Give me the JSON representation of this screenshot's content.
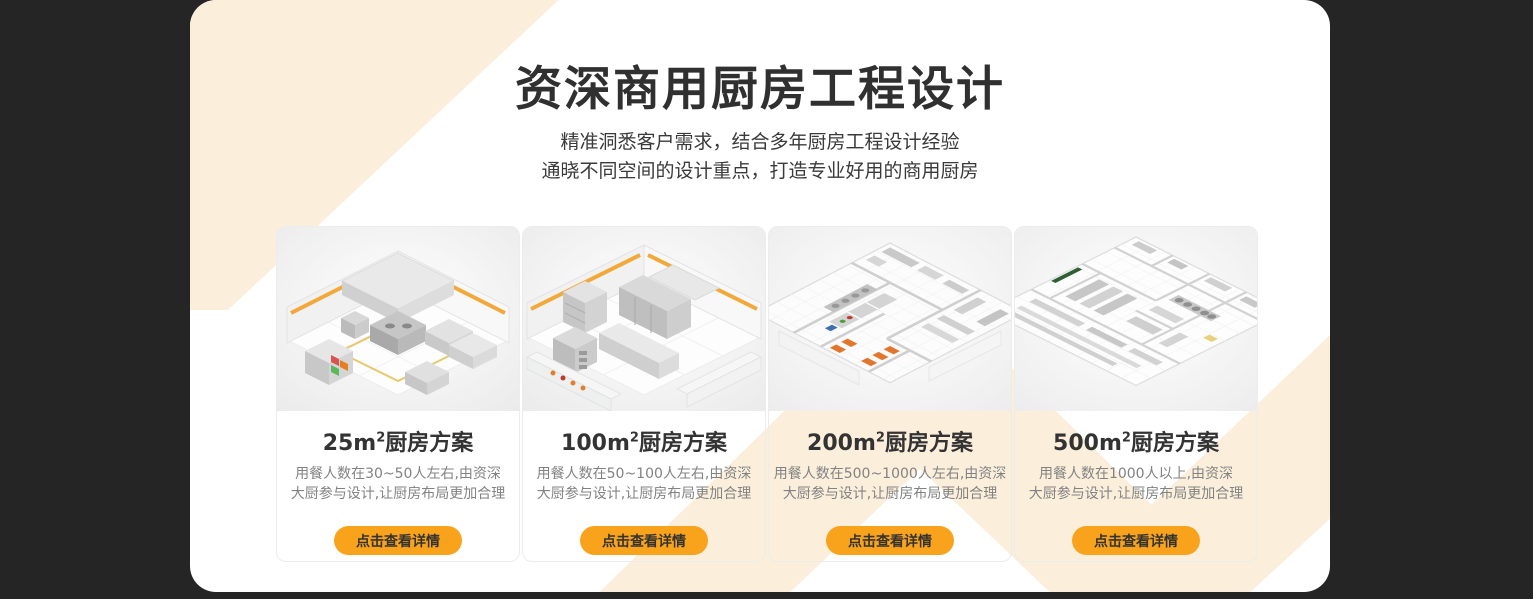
{
  "header": {
    "title": "资深商用厨房工程设计",
    "subtitle_line1": "精准洞悉客户需求，结合多年厨房工程设计经验",
    "subtitle_line2": "通晓不同空间的设计重点，打造专业好用的商用厨房"
  },
  "colors": {
    "accent_orange": "#F9A21C",
    "cream_decoration": "#FBEFDC",
    "panel_background": "#FFFFFF",
    "page_background": "#252525",
    "title_text": "#303030",
    "description_text": "#828282",
    "wall_stripe_yellow": "#F2A93B"
  },
  "cards": [
    {
      "title_prefix": "25m",
      "title_sup": "2",
      "title_suffix": "厨房方案",
      "desc_line1": "用餐人数在30~50人左右,由资深",
      "desc_line2": "大厨参与设计,让厨房布局更加合理",
      "button_label": "点击查看详情"
    },
    {
      "title_prefix": "100m",
      "title_sup": "2",
      "title_suffix": "厨房方案",
      "desc_line1": "用餐人数在50~100人左右,由资深",
      "desc_line2": "大厨参与设计,让厨房布局更加合理",
      "button_label": "点击查看详情"
    },
    {
      "title_prefix": "200m",
      "title_sup": "2",
      "title_suffix": "厨房方案",
      "desc_line1": "用餐人数在500~1000人左右,由资深",
      "desc_line2": "大厨参与设计,让厨房布局更加合理",
      "button_label": "点击查看详情"
    },
    {
      "title_prefix": "500m",
      "title_sup": "2",
      "title_suffix": "厨房方案",
      "desc_line1": "用餐人数在1000人以上,由资深",
      "desc_line2": "大厨参与设计,让厨房布局更加合理",
      "button_label": "点击查看详情"
    }
  ]
}
